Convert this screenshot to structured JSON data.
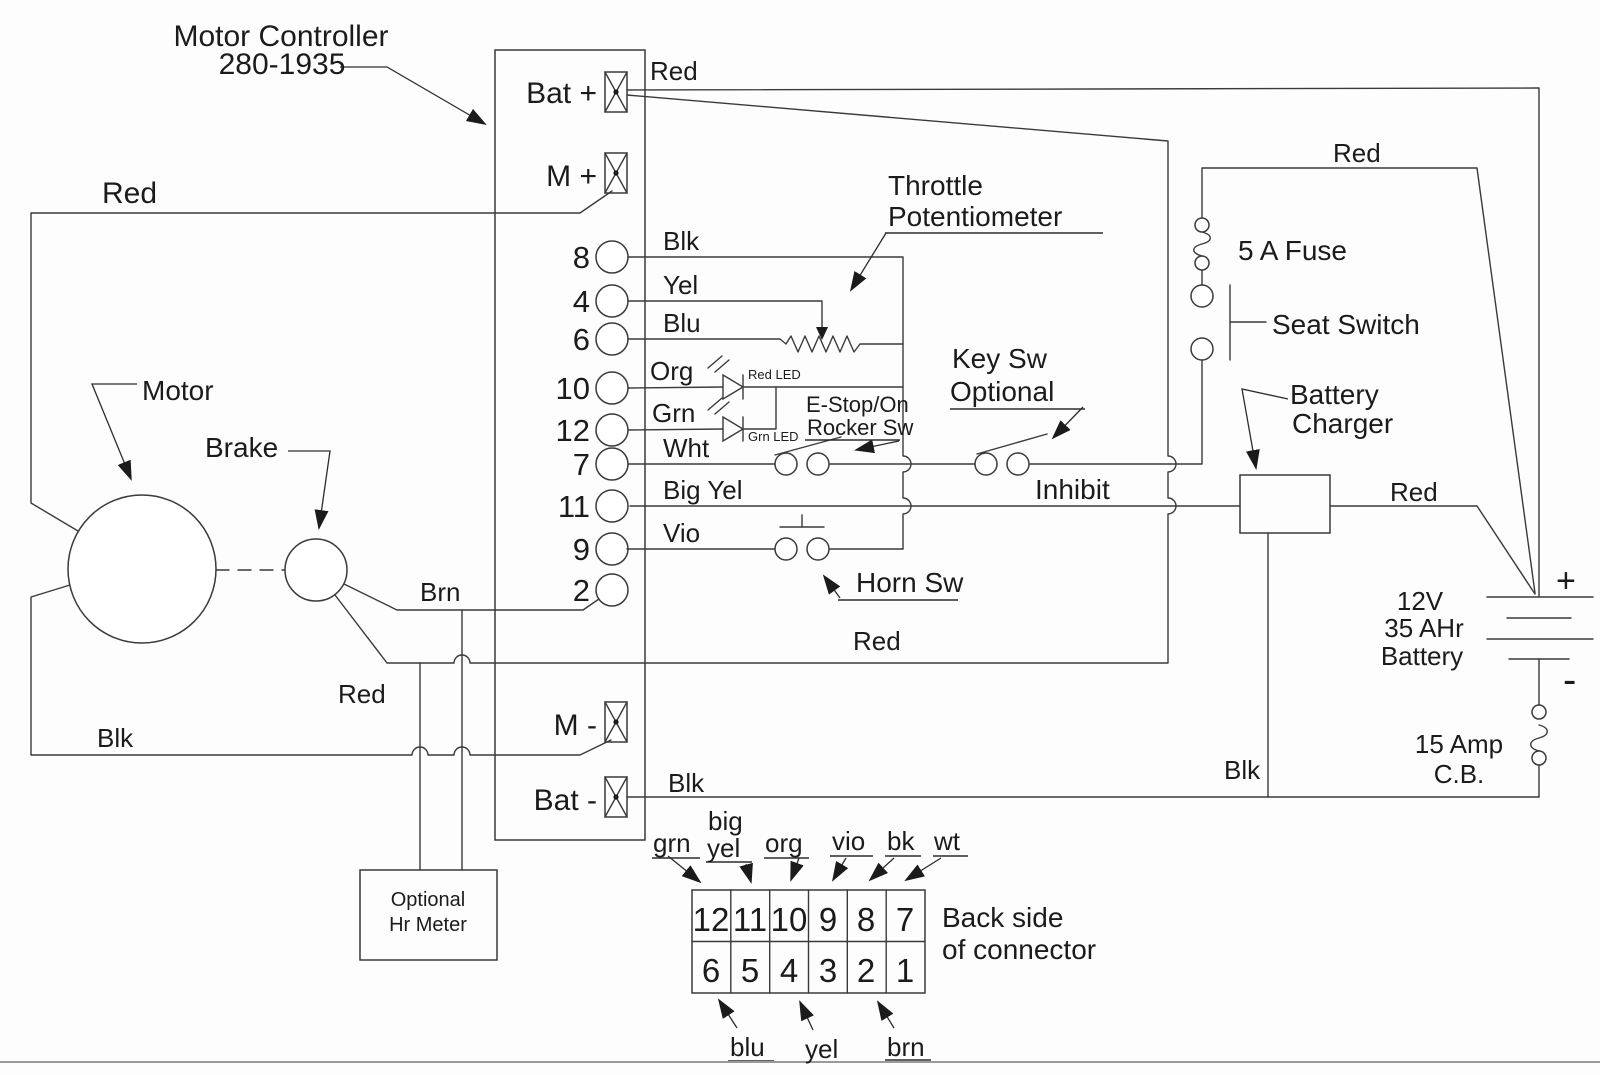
{
  "diagram": {
    "title": {
      "line1": "Motor Controller",
      "line2": "280-1935"
    },
    "terminals": {
      "bat_plus": "Bat +",
      "m_plus": "M +",
      "m_minus": "M -",
      "bat_minus": "Bat -"
    },
    "pin_numbers": [
      "8",
      "4",
      "6",
      "10",
      "12",
      "7",
      "11",
      "9",
      "2"
    ],
    "wire_labels": {
      "red": "Red",
      "blk": "Blk",
      "yel": "Yel",
      "blu": "Blu",
      "org": "Org",
      "grn": "Grn",
      "wht": "Wht",
      "big_yel": "Big Yel",
      "vio": "Vio",
      "brn": "Brn"
    },
    "components": {
      "throttle_pot": {
        "line1": "Throttle",
        "line2": "Potentiometer"
      },
      "red_led": "Red LED",
      "grn_led": "Grn LED",
      "estop": {
        "line1": "E-Stop/On",
        "line2": "Rocker Sw"
      },
      "key_sw": {
        "line1": "Key Sw",
        "line2": "Optional"
      },
      "horn_sw": "Horn Sw",
      "inhibit": "Inhibit",
      "fuse": "5 A Fuse",
      "seat_switch": "Seat Switch",
      "battery_charger": {
        "line1": "Battery",
        "line2": "Charger"
      },
      "battery": {
        "line1": "12V",
        "line2": "35 AHr",
        "line3": "Battery",
        "plus": "+",
        "minus": "-"
      },
      "circuit_breaker": {
        "line1": "15 Amp",
        "line2": "C.B."
      },
      "motor": "Motor",
      "brake": "Brake",
      "hr_meter": {
        "line1": "Optional",
        "line2": "Hr Meter"
      }
    },
    "connector": {
      "top_row": [
        "12",
        "11",
        "10",
        "9",
        "8",
        "7"
      ],
      "bottom_row": [
        "6",
        "5",
        "4",
        "3",
        "2",
        "1"
      ],
      "top_labels": {
        "grn": "grn",
        "big": "big",
        "yel": "yel",
        "org": "org",
        "vio": "vio",
        "bk": "bk",
        "wt": "wt"
      },
      "bottom_labels": {
        "blu": "blu",
        "yel": "yel",
        "brn": "brn"
      },
      "caption": {
        "line1": "Back side",
        "line2": "of connector"
      }
    }
  }
}
